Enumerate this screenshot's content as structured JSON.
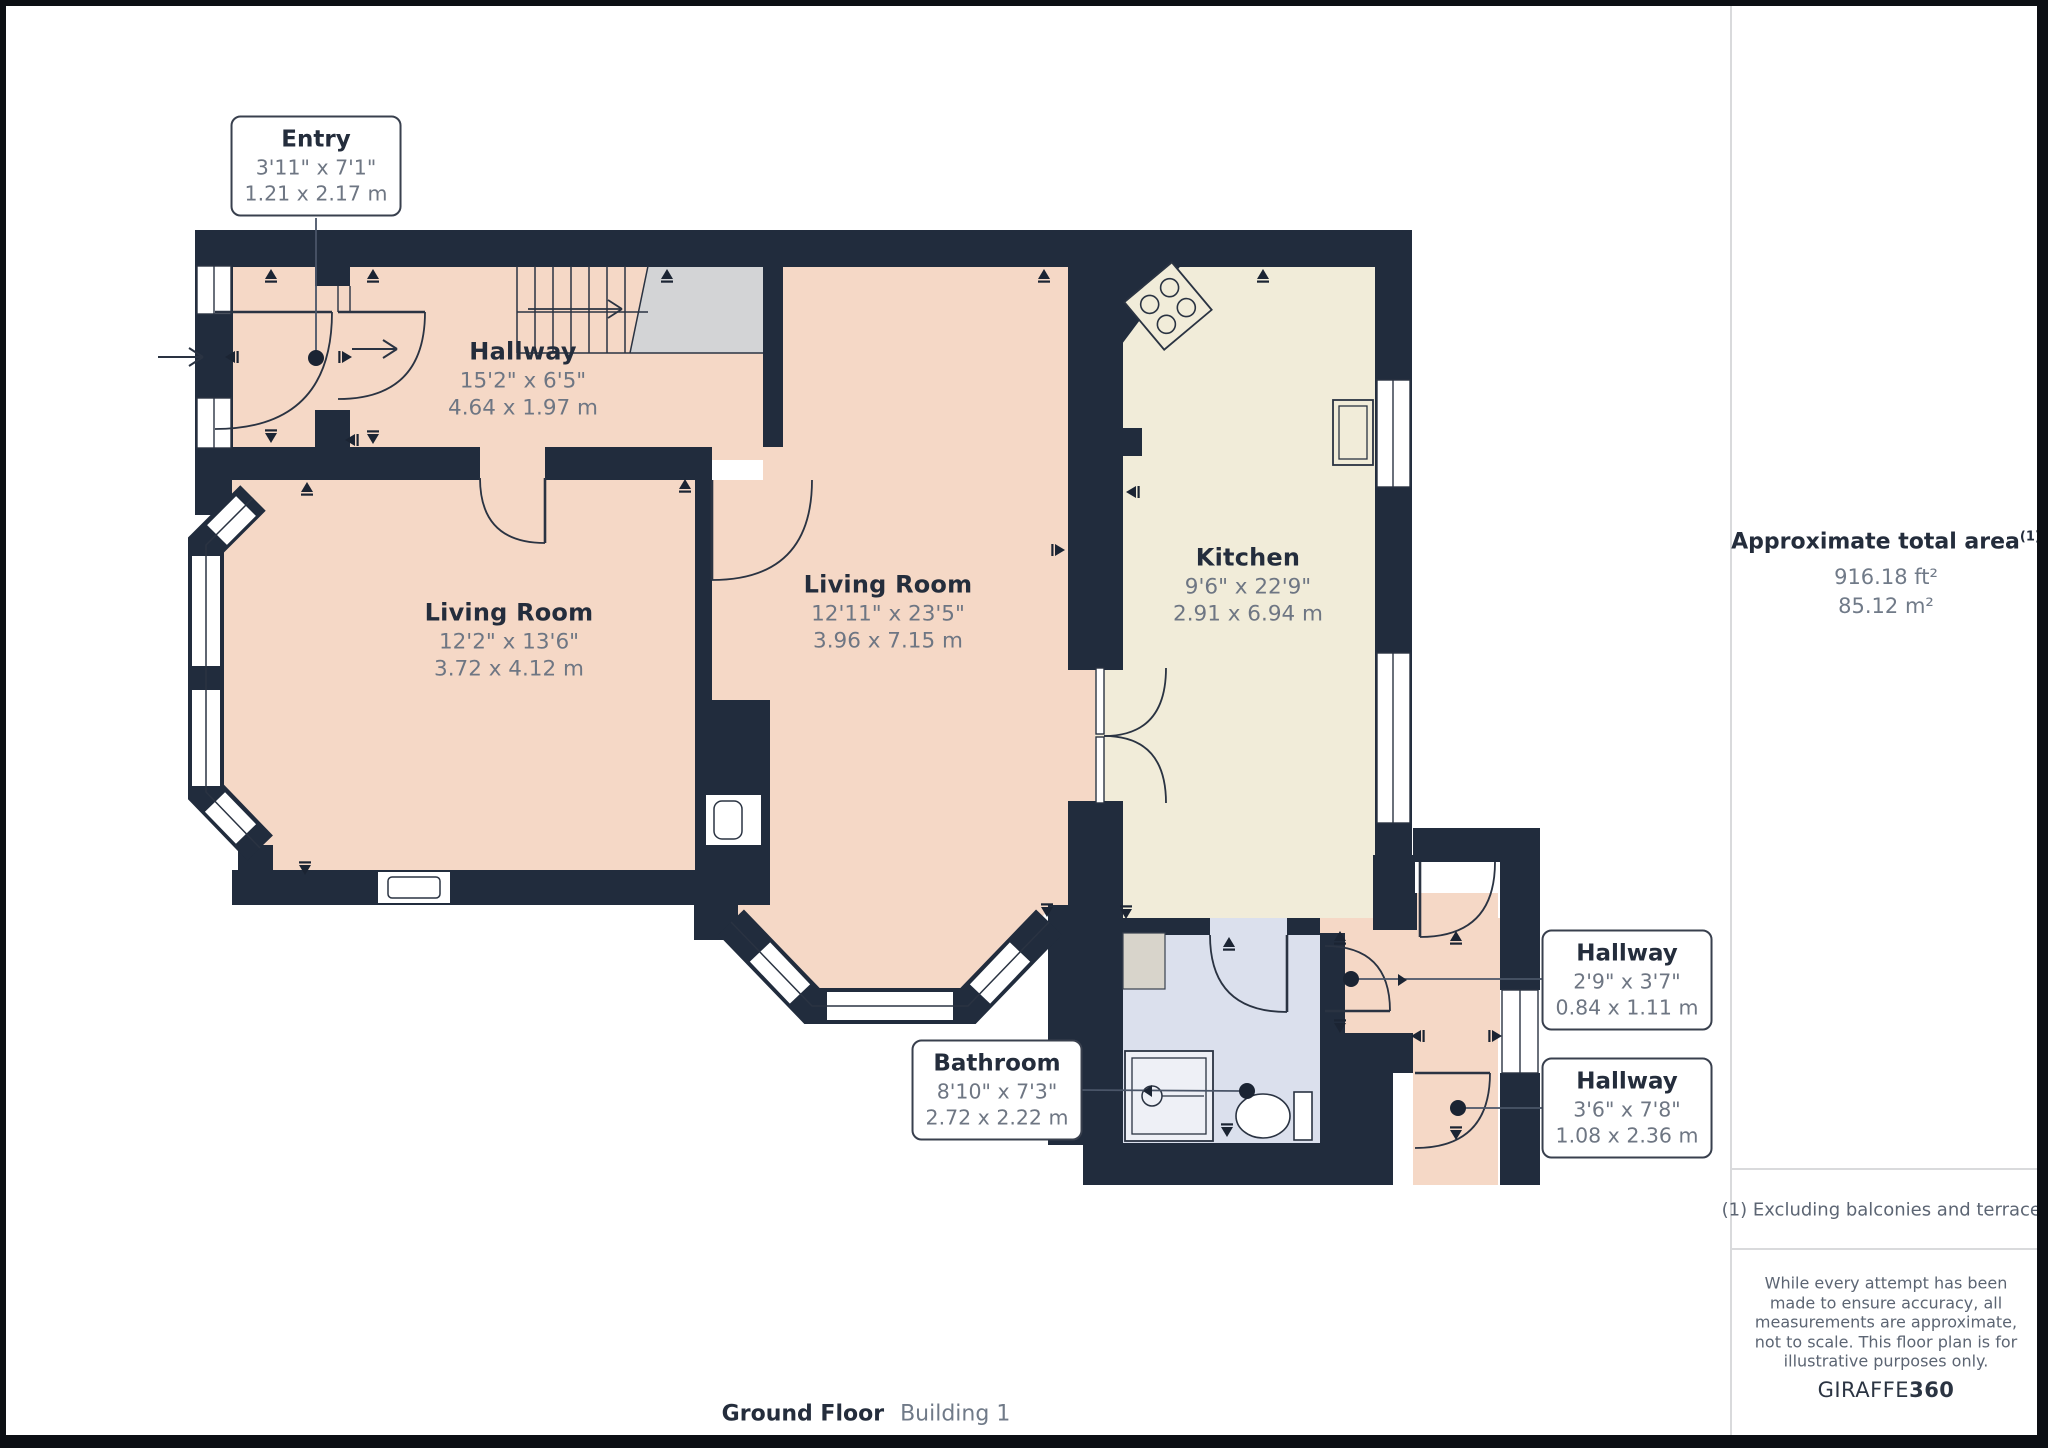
{
  "plan": {
    "rooms": [
      {
        "id": "hallway-main",
        "name": "Hallway",
        "imperial": "15'2\" x 6'5\"",
        "metric": "4.64 x 1.97 m"
      },
      {
        "id": "living-room-1",
        "name": "Living Room",
        "imperial": "12'2\" x 13'6\"",
        "metric": "3.72 x 4.12 m"
      },
      {
        "id": "living-room-2",
        "name": "Living Room",
        "imperial": "12'11\" x 23'5\"",
        "metric": "3.96 x 7.15 m"
      },
      {
        "id": "kitchen",
        "name": "Kitchen",
        "imperial": "9'6\" x 22'9\"",
        "metric": "2.91 x 6.94 m"
      }
    ],
    "boxed_labels": [
      {
        "id": "entry",
        "name": "Entry",
        "imperial": "3'11\" x 7'1\"",
        "metric": "1.21 x 2.17 m"
      },
      {
        "id": "bathroom",
        "name": "Bathroom",
        "imperial": "8'10\" x 7'3\"",
        "metric": "2.72 x 2.22 m"
      },
      {
        "id": "hallway-upper",
        "name": "Hallway",
        "imperial": "2'9\" x 3'7\"",
        "metric": "0.84 x 1.11 m"
      },
      {
        "id": "hallway-lower",
        "name": "Hallway",
        "imperial": "3'6\" x 7'8\"",
        "metric": "1.08 x 2.36 m"
      }
    ]
  },
  "sidebar": {
    "title": "Approximate total area",
    "title_superscript": "(1)",
    "area_ft": "916.18 ft²",
    "area_m": "85.12 m²",
    "footnote": "(1) Excluding balconies and terraces",
    "disclaimer": "While every attempt has been made to ensure accuracy, all measurements are approximate, not to scale. This floor plan is for illustrative purposes only.",
    "brand_name": "GIRAFFE",
    "brand_number": "360"
  },
  "footer": {
    "floor": "Ground Floor",
    "building": "Building 1"
  },
  "colors": {
    "wall": "#212c3d",
    "floor_salmon": "#f5d8c6",
    "floor_cream": "#f1ecd9",
    "floor_blue": "#dbe0ed",
    "landing_gray": "#d3d4d6"
  }
}
